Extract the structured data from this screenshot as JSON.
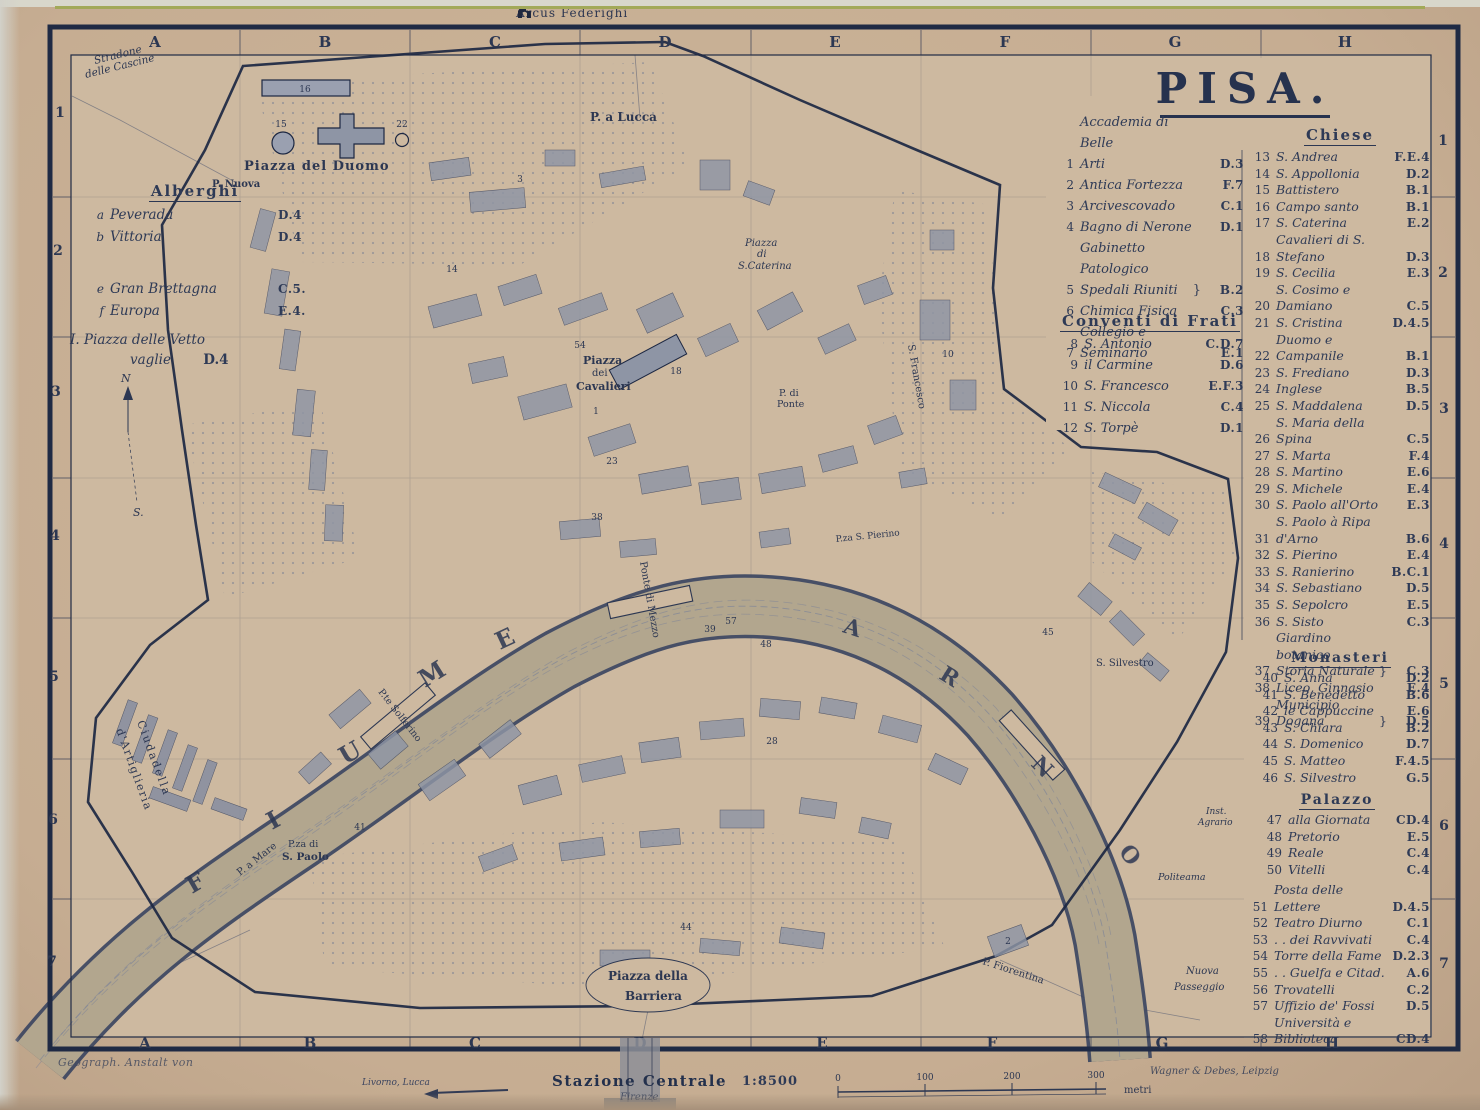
{
  "title": "PISA.",
  "top_label": "Arcus Federighi",
  "grid": {
    "cols": [
      "A",
      "B",
      "C",
      "D",
      "E",
      "F",
      "G",
      "H"
    ],
    "rows": [
      "1",
      "2",
      "3",
      "4",
      "5",
      "6",
      "7"
    ]
  },
  "colors": {
    "ink": "#2c3752",
    "paper": "#c6ad92",
    "map_paper": "#cdb9a0",
    "building": "#8e95a5",
    "river": "#b2a68e"
  },
  "legend_general": {
    "items": [
      {
        "num": "1",
        "name": "Accademia di Belle\nArti",
        "ref": "D.3"
      },
      {
        "num": "2",
        "name": "Antica Fortezza",
        "ref": "F.7"
      },
      {
        "num": "3",
        "name": "Arcivescovado",
        "ref": "C.1"
      },
      {
        "num": "4",
        "name": "Bagno di Nerone",
        "ref": "D.1"
      },
      {
        "num": "5",
        "name": "Gabinetto Patologico\nSpedali Riuniti",
        "brace": "}",
        "ref": "B.2"
      },
      {
        "num": "6",
        "name": "Chimica Fisica",
        "ref": "C.3"
      },
      {
        "num": "7",
        "name": "Collegio e Seminario",
        "ref": "E.1"
      }
    ]
  },
  "conventi": {
    "header": "Conventi di Frati",
    "items": [
      {
        "num": "8",
        "name": "S. Antonio",
        "ref": "C.D.7"
      },
      {
        "num": "9",
        "name": "il Carmine",
        "ref": "D.6"
      },
      {
        "num": "10",
        "name": "S. Francesco",
        "ref": "E.F.3"
      },
      {
        "num": "11",
        "name": "S. Niccola",
        "ref": "C.4"
      },
      {
        "num": "12",
        "name": "S. Torpè",
        "ref": "D.1"
      }
    ]
  },
  "chiese": {
    "header": "Chiese",
    "items": [
      {
        "num": "13",
        "name": "S. Andrea",
        "ref": "F.E.4"
      },
      {
        "num": "14",
        "name": "S. Appollonia",
        "ref": "D.2"
      },
      {
        "num": "15",
        "name": "Battistero",
        "ref": "B.1"
      },
      {
        "num": "16",
        "name": "Campo santo",
        "ref": "B.1"
      },
      {
        "num": "17",
        "name": "S. Caterina",
        "ref": "E.2"
      },
      {
        "num": "18",
        "name": "Cavalieri di S. Stefano",
        "ref": "D.3"
      },
      {
        "num": "19",
        "name": "S. Cecilia",
        "ref": "E.3"
      },
      {
        "num": "20",
        "name": "S. Cosimo e Damiano",
        "ref": "C.5"
      },
      {
        "num": "21",
        "name": "S. Cristina",
        "ref": "D.4.5"
      },
      {
        "num": "22",
        "name": "Duomo e Campanile",
        "ref": "B.1"
      },
      {
        "num": "23",
        "name": "S. Frediano",
        "ref": "D.3"
      },
      {
        "num": "24",
        "name": "Inglese",
        "ref": "B.5"
      },
      {
        "num": "25",
        "name": "S. Maddalena",
        "ref": "D.5"
      },
      {
        "num": "26",
        "name": "S. Maria della Spina",
        "ref": "C.5"
      },
      {
        "num": "27",
        "name": "S. Marta",
        "ref": "F.4"
      },
      {
        "num": "28",
        "name": "S. Martino",
        "ref": "E.6"
      },
      {
        "num": "29",
        "name": "S. Michele",
        "ref": "E.4"
      },
      {
        "num": "30",
        "name": "S. Paolo all'Orto",
        "ref": "E.3"
      },
      {
        "num": "31",
        "name": "S. Paolo à Ripa d'Arno",
        "ref": "B.6"
      },
      {
        "num": "32",
        "name": "S. Pierino",
        "ref": "E.4"
      },
      {
        "num": "33",
        "name": "S. Ranierino",
        "ref": "B.C.1"
      },
      {
        "num": "34",
        "name": "S. Sebastiano",
        "ref": "D.5"
      },
      {
        "num": "35",
        "name": "S. Sepolcro",
        "ref": "E.5"
      },
      {
        "num": "36",
        "name": "S. Sisto",
        "ref": "C.3"
      },
      {
        "num": "37",
        "name": "Giardino botanico\nStoria Naturale",
        "brace": "}",
        "ref": "C.3"
      },
      {
        "num": "38",
        "name": "Liceo, Ginnasio",
        "ref": "E.4"
      },
      {
        "num": "39",
        "name": "Municipio\nDogana",
        "brace": "}",
        "ref": "D.5"
      }
    ]
  },
  "monasteri": {
    "header": "Monasteri",
    "items": [
      {
        "num": "40",
        "name": "S. Anna",
        "ref": "D.2"
      },
      {
        "num": "41",
        "name": "S. Benedetto",
        "ref": "B.6"
      },
      {
        "num": "42",
        "name": "le Cappuccine",
        "ref": "E.6"
      },
      {
        "num": "43",
        "name": "S. Chiara",
        "ref": "B.2"
      },
      {
        "num": "44",
        "name": "S. Domenico",
        "ref": "D.7"
      },
      {
        "num": "45",
        "name": "S. Matteo",
        "ref": "F.4.5"
      },
      {
        "num": "46",
        "name": "S. Silvestro",
        "ref": "G.5"
      }
    ]
  },
  "palazzo": {
    "header": "Palazzo",
    "items": [
      {
        "num": "47",
        "name": "alla Giornata",
        "ref": "CD.4"
      },
      {
        "num": "48",
        "name": "Pretorio",
        "ref": "E.5"
      },
      {
        "num": "49",
        "name": "Reale",
        "ref": "C.4"
      },
      {
        "num": "50",
        "name": "Vitelli",
        "ref": "C.4"
      }
    ]
  },
  "varie": {
    "items": [
      {
        "num": "51",
        "name": "Posta delle Lettere",
        "ref": "D.4.5"
      },
      {
        "num": "52",
        "name": "Teatro Diurno",
        "ref": "C.1"
      },
      {
        "num": "53",
        "name": ". . dei Ravvivati",
        "ref": "C.4"
      },
      {
        "num": "54",
        "name": "Torre della Fame",
        "ref": "D.2.3"
      },
      {
        "num": "55",
        "name": ". . Guelfa e Citad.",
        "ref": "A.6"
      },
      {
        "num": "56",
        "name": "Trovatelli",
        "ref": "C.2"
      },
      {
        "num": "57",
        "name": "Uffizio de' Fossi",
        "ref": "D.5"
      },
      {
        "num": "58",
        "name": "Università e\nBiblioteca",
        "ref": "CD.4"
      }
    ]
  },
  "alberghi": {
    "header": "Alberghi",
    "items_ab": [
      {
        "num": "a",
        "name": "Peverada",
        "ref": "D.4"
      },
      {
        "num": "b",
        "name": "Vittoria",
        "ref": "D.4"
      }
    ],
    "items_ef": [
      {
        "num": "e",
        "name": "Gran Brettagna",
        "ref": "C.5."
      },
      {
        "num": "f",
        "name": "Europa",
        "ref": "E.4."
      }
    ],
    "note_line1": "I. Piazza delle Vetto",
    "note_line2": "vaglie",
    "note_ref": "D.4"
  },
  "compass": {
    "north": "N",
    "south": "S."
  },
  "map_labels": {
    "stradone1": "Stradone",
    "stradone2": "delle Cascine",
    "p_nuova": "P. Nuova",
    "piazza_duomo": "Piazza del Duomo",
    "p_a_lucca": "P. a Lucca",
    "cat1": "Piazza",
    "cat2": "di",
    "cat3": "S.Caterina",
    "cav1": "Piazza",
    "cav2": "dei",
    "cav3": "Cavalieri",
    "s_francesco": "S. Francesco",
    "pp1": "P. di",
    "pp2": "Ponte",
    "pierino": "P.za S. Pierino",
    "mezzo": "Ponte di Mezzo",
    "solferino": "P.te Solferino",
    "silvestro": "S. Silvestro",
    "sp1": "P.za di",
    "sp2": "S. Paolo",
    "p_a_mare": "P. a Mare",
    "bar1": "Piazza della",
    "bar2": "Barriera",
    "fiorentina": "P. Fiorentina",
    "np1": "Nuova",
    "np2": "Passeggio",
    "politeama": "Politeama",
    "inst1": "Inst.",
    "inst2": "Agrario",
    "cit1": "Ciudadella",
    "cit2": "d'Artiglieria"
  },
  "river": {
    "fiume": [
      "F",
      "I",
      "U",
      "M",
      "E"
    ],
    "arno": [
      "A",
      "R",
      "N",
      "O"
    ]
  },
  "map_numbers": [
    "16",
    "15",
    "22",
    "3",
    "54",
    "18",
    "1",
    "10",
    "23",
    "38",
    "39",
    "57",
    "48",
    "41",
    "44",
    "2",
    "45",
    "28",
    "14"
  ],
  "footer": {
    "credit_left": "Geograph. Anstalt von",
    "dest": "Livorno, Lucca",
    "station": "Stazione Centrale",
    "station_sub": "Firenze",
    "scale_ratio": "1:8500",
    "scale_ticks": [
      "0",
      "100",
      "200",
      "300"
    ],
    "scale_unit": "metri",
    "credit_right": "Wagner & Debes, Leipzig"
  }
}
